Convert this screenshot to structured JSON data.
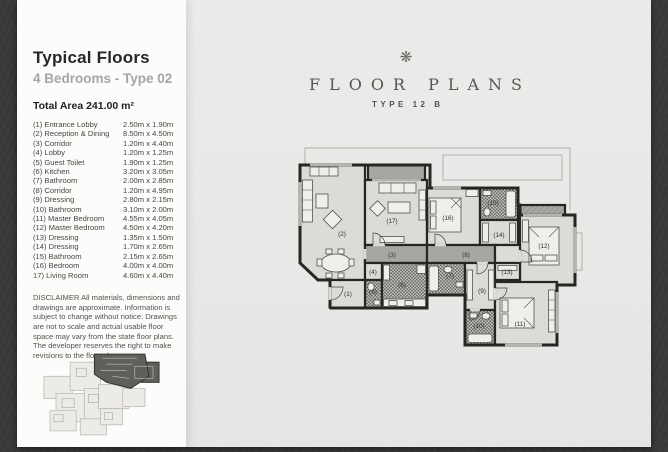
{
  "page": {
    "desk_color": "#3a3a3c",
    "paper_color": "#e9e8e6",
    "sidebar_color": "#fcfcfb"
  },
  "sidebar": {
    "title": "Typical Floors",
    "subtitle": "4 Bedrooms - Type 02",
    "total_area": "Total Area 241.00 m²",
    "rooms": [
      {
        "label": "(1) Entrance Lobby",
        "dims": "2.50m x 1.90m"
      },
      {
        "label": "(2) Reception & Dining",
        "dims": "8.50m x 4.50m"
      },
      {
        "label": "(3) Corridor",
        "dims": "1.20m x 4.40m"
      },
      {
        "label": "(4) Lobby",
        "dims": "1.20m x 1.25m"
      },
      {
        "label": "(5) Guest Toilet",
        "dims": "1.90m x 1.25m"
      },
      {
        "label": "(6) Kitchen",
        "dims": "3.20m x 3.05m"
      },
      {
        "label": "(7) Bathroom",
        "dims": "2.00m x 2.85m"
      },
      {
        "label": "(8) Corridor",
        "dims": "1.20m x 4.95m"
      },
      {
        "label": "(9) Dressing",
        "dims": "2.80m x 2.15m"
      },
      {
        "label": "(10) Bathroom",
        "dims": "3.10m x 2.00m"
      },
      {
        "label": "(11) Master Bedroom",
        "dims": "4.55m x 4.05m"
      },
      {
        "label": "(12) Master Bedroom",
        "dims": "4.50m x 4.20m"
      },
      {
        "label": "(13) Dressing",
        "dims": "1.35m x 1.50m"
      },
      {
        "label": "(14) Dressing",
        "dims": "1.70m x 2.65m"
      },
      {
        "label": "(15) Bathroom",
        "dims": "2.15m x 2.65m"
      },
      {
        "label": "(16) Bedroom",
        "dims": "4.00m x 4.00m"
      },
      {
        "label": "17) Living Room",
        "dims": "4.60m x 4.40m"
      }
    ],
    "disclaimer": "DISCLAIMER All materials, dimensions and drawings are approximate. Information is subject to change without notice. Drawings are not to scale and actual usable floor space may vary from the state floor plans. The developer reserves the right to make revisions to the floor plans."
  },
  "plan_header": {
    "ornament": "❋",
    "title": "FLOOR PLANS",
    "subtitle": "TYPE 12 B"
  },
  "plan": {
    "labels": [
      "(1)",
      "(2)",
      "(3)",
      "(4)",
      "(5)",
      "(6)",
      "(7)",
      "(8)",
      "(9)",
      "(10)",
      "(11)",
      "(12)",
      "(13)",
      "(14)",
      "(15)",
      "(16)",
      "(17)"
    ]
  }
}
